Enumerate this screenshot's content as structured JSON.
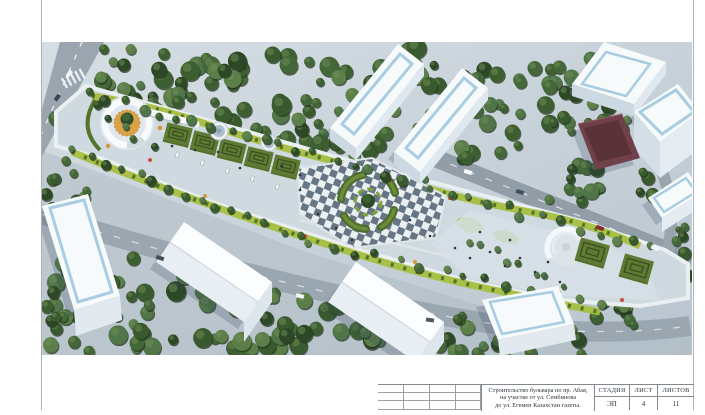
{
  "title_block": {
    "project_title_line1": "Строительство бульвара по пр. Абая,",
    "project_title_line2": "на участке от ул. Сембинова",
    "project_title_line3": "до ул. Егемен Казахстан газеты.",
    "stage_label": "СТАДИЯ",
    "stage_value": "ЭП",
    "sheet_label": "ЛИСТ",
    "sheet_value": "4",
    "sheets_label": "ЛИСТОВ",
    "sheets_value": "11"
  },
  "palette": {
    "paving_light": "#cfd9e0",
    "road_gray": "#97a3ad",
    "tree_green": "#44663a",
    "lawn_green": "#a6bf3f",
    "hedge_green": "#54742e",
    "building_white": "#f7fafb",
    "roof_accent_blue": "#a8cde2",
    "red_roof": "#71414b",
    "checker_dark": "#677684",
    "flower_orange": "#d9973c"
  }
}
